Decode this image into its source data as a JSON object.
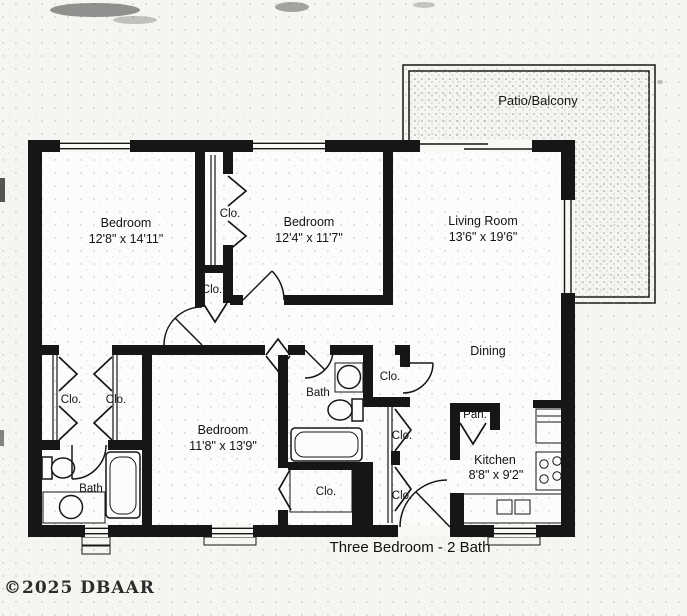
{
  "page": {
    "caption": "Three Bedroom - 2 Bath",
    "watermark": "©2025 DBAAR"
  },
  "rooms": {
    "patio": {
      "label": "Patio/Balcony"
    },
    "bedroom_1": {
      "label": "Bedroom",
      "dims": "12'8\" x 14'11\""
    },
    "bedroom_2": {
      "label": "Bedroom",
      "dims": "12'4\" x 11'7\""
    },
    "bedroom_3": {
      "label": "Bedroom",
      "dims": "11'8\" x 13'9\""
    },
    "living_room": {
      "label": "Living Room",
      "dims": "13'6\" x 19'6\""
    },
    "dining": {
      "label": "Dining"
    },
    "kitchen": {
      "label": "Kitchen",
      "dims": "8'8\" x 9'2\""
    },
    "bath": {
      "label": "Bath"
    },
    "pantry": {
      "label": "Pan."
    },
    "closet": {
      "label": "Clo."
    }
  },
  "colors": {
    "ink": "#161616",
    "paper": "#f5f5f1"
  }
}
